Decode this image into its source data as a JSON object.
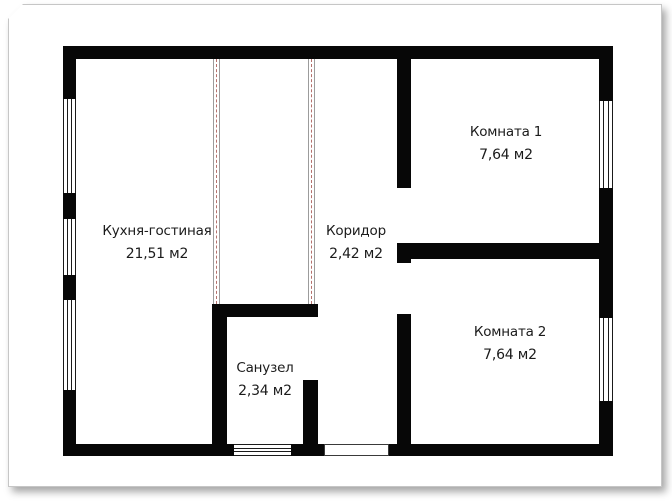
{
  "plan_title": "apartment-floor-plan",
  "colors": {
    "wall": "#070707",
    "page_border": "#c6c6c6",
    "partition_outline": "#9c9c9c",
    "partition_dash": "#b5716d",
    "background": "#ffffff"
  },
  "rooms": [
    {
      "name": "Кухня-гостиная",
      "area": "21,51 м2"
    },
    {
      "name": "Коридор",
      "area": "2,42 м2"
    },
    {
      "name": "Санузел",
      "area": "2,34 м2"
    },
    {
      "name": "Комната 1",
      "area": "7,64 м2"
    },
    {
      "name": "Комната 2",
      "area": "7,64 м2"
    }
  ]
}
